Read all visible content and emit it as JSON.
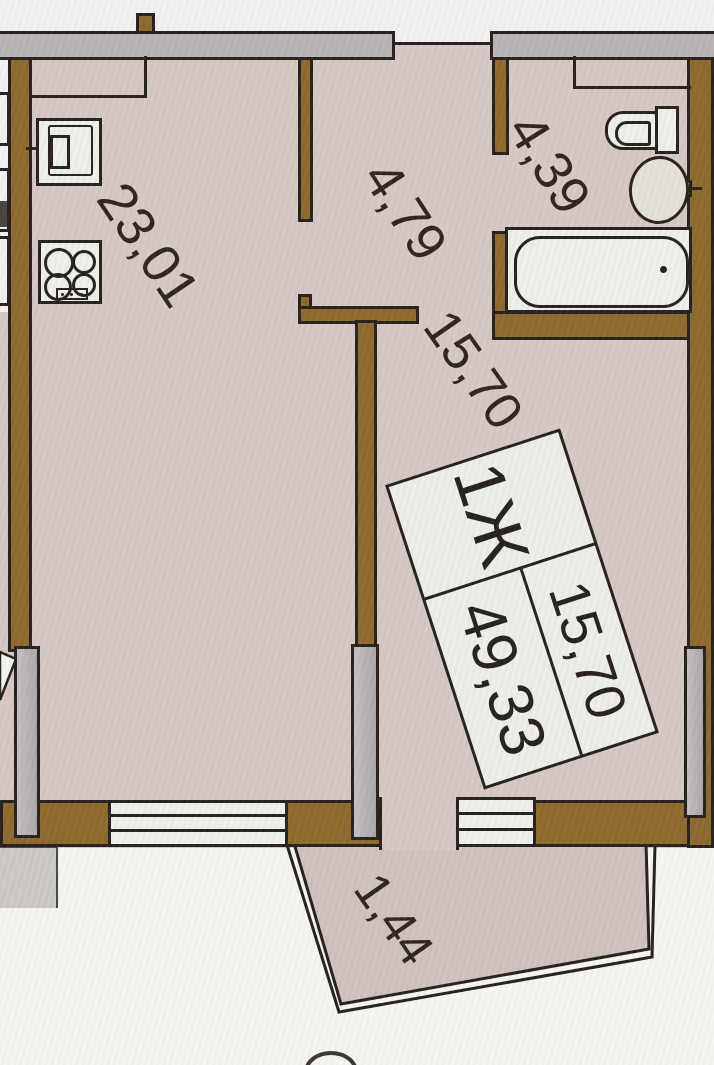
{
  "title": "Apartment floor plan",
  "labels": {
    "kitchen_living": "23,01",
    "hallway": "4,79",
    "bathroom": "4,39",
    "room": "15,70",
    "balcony": "1,44"
  },
  "unit_card": {
    "type": "1Ж",
    "living_area": "15,70",
    "total_area": "49,33"
  },
  "colors": {
    "wall_brown": "#8c682c",
    "floor_beige": "#d6c8c3",
    "balcony_floor": "#cfc2bd",
    "outline_black": "#241f1b",
    "window_gray": "#b9b4b6",
    "fixture_white": "#edefe9"
  }
}
